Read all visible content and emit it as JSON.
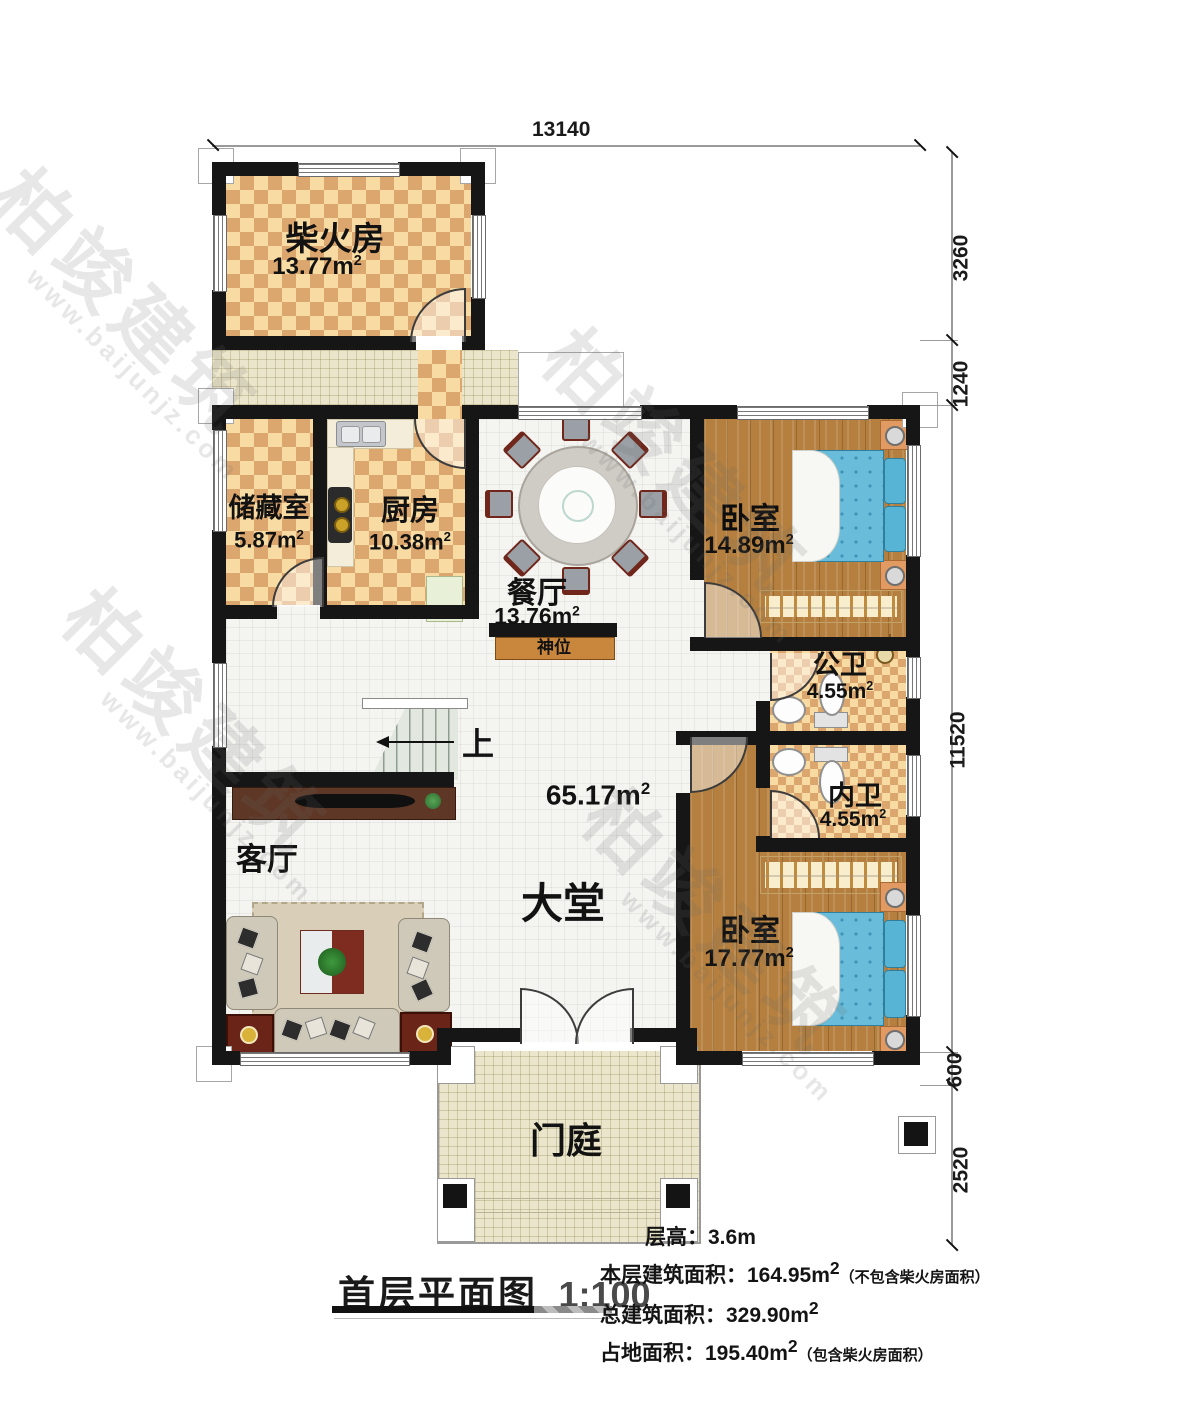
{
  "plan": {
    "title": "首层平面图",
    "scale": "1:100",
    "watermark": {
      "brand": "柏竣建筑",
      "url": "www.baijunjz.com"
    },
    "dimensions": {
      "top_width": "13140",
      "right": [
        "3260",
        "1240",
        "11520",
        "600",
        "2520"
      ]
    },
    "rooms": {
      "firewood": {
        "name": "柴火房",
        "area": "13.77m",
        "sup": "2"
      },
      "storage": {
        "name": "储藏室",
        "area": "5.87m",
        "sup": "2"
      },
      "kitchen": {
        "name": "厨房",
        "area": "10.38m",
        "sup": "2"
      },
      "dining": {
        "name": "餐厅",
        "area": "13.76m",
        "sup": "2"
      },
      "bedroom1": {
        "name": "卧室",
        "area": "14.89m",
        "sup": "2"
      },
      "bath_public": {
        "name": "公卫",
        "area": "4.55m",
        "sup": "2"
      },
      "bath_private": {
        "name": "内卫",
        "area": "4.55m",
        "sup": "2"
      },
      "bedroom2": {
        "name": "卧室",
        "area": "17.77m",
        "sup": "2"
      },
      "living": {
        "name": "客厅"
      },
      "hall": {
        "name": "大堂",
        "area": "65.17m",
        "sup": "2"
      },
      "porch": {
        "name": "门庭"
      },
      "shrine": {
        "name": "神位"
      },
      "stairs": {
        "up_label": "上"
      }
    },
    "info": {
      "floor_height_label": "层高：",
      "floor_height_value": "3.6m",
      "line2_label": "本层建筑面积：",
      "line2_value": "164.95m",
      "line2_sup": "2",
      "line2_note": "（不包含柴火房面积）",
      "line3_label": "总建筑面积：",
      "line3_value": "329.90m",
      "line3_sup": "2",
      "line4_label": "占地面积：",
      "line4_value": "195.40m",
      "line4_sup": "2",
      "line4_note": "（包含柴火房面积）"
    }
  }
}
